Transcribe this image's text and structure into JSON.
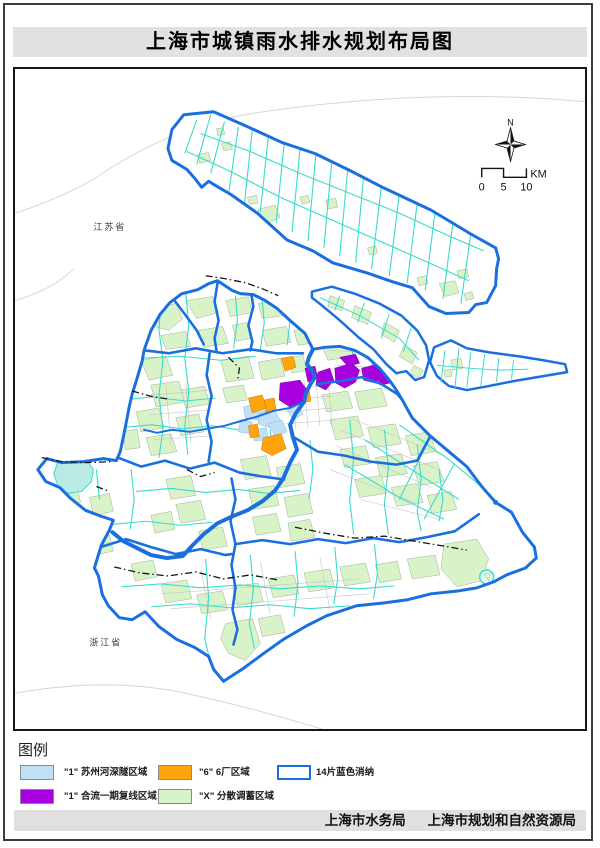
{
  "title": "上海市城镇雨水排水规划布局图",
  "map": {
    "labels": {
      "jiangsu": "江苏省",
      "zhejiang": "浙江省"
    },
    "compass": {
      "north": "N"
    },
    "scale": {
      "unit": "KM",
      "ticks": [
        "0",
        "5",
        "10"
      ]
    }
  },
  "legend": {
    "heading": "图例",
    "items": [
      {
        "id": "suzhou-creek-deep-tunnel",
        "label": "\"1\" 苏州河深隧区域",
        "color": "#BFE0F5",
        "style": "fill"
      },
      {
        "id": "combined-sewer-phase1",
        "label": "\"1\" 合流一期复线区域",
        "color": "#A800DE",
        "style": "fill"
      },
      {
        "id": "six-plants-zone",
        "label": "\"6\" 6厂区域",
        "color": "#FFA40D",
        "style": "fill"
      },
      {
        "id": "dispersed-storage-zone",
        "label": "\"X\" 分散调蓄区域",
        "color": "#D9F3C9",
        "style": "fill"
      },
      {
        "id": "blue-absorption-14",
        "label": "14片蓝色消纳",
        "color": "#1A6FE0",
        "style": "outline"
      }
    ]
  },
  "footer": {
    "agencies": [
      "上海市水务局",
      "上海市规划和自然资源局"
    ]
  },
  "palette": {
    "boundary_blue": "#1A6FE0",
    "river_cyan": "#35DCCC",
    "green_area": "#D9F3C9",
    "purple_area": "#A800DE",
    "orange_area": "#FFA40D",
    "light_blue_area": "#BFE0F5",
    "lake_fill": "#B9EAE4",
    "bar_gray": "#E1E1E1"
  }
}
